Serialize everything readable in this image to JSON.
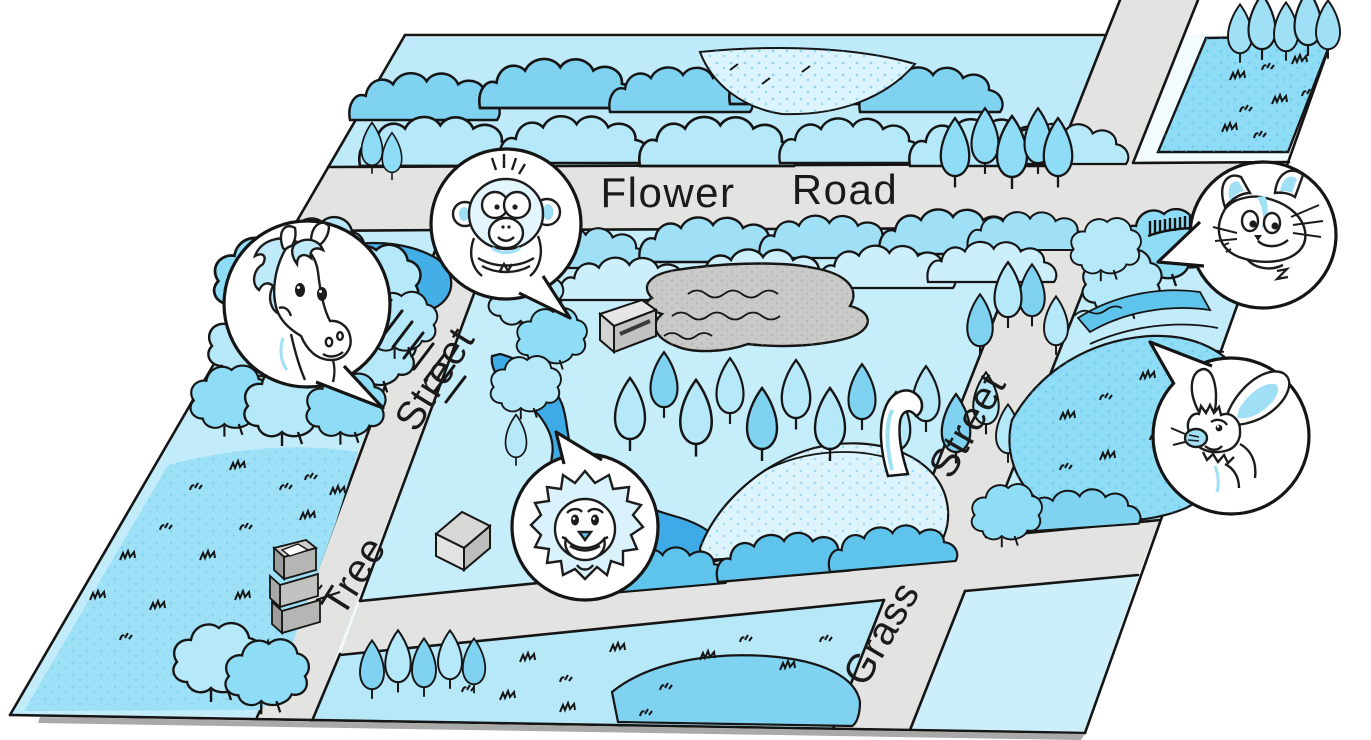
{
  "map": {
    "streets": {
      "flower_road": {
        "words": [
          "Flower",
          "Road"
        ]
      },
      "tree_street": {
        "words": [
          "Tree",
          "Street"
        ]
      },
      "grass_street": {
        "words": [
          "Grass",
          "Street"
        ]
      }
    },
    "animals": [
      "horse",
      "monkey",
      "cat",
      "rabbit",
      "lion"
    ],
    "features": [
      "forest",
      "park",
      "gray-pond",
      "river",
      "hill",
      "slide",
      "kiosk",
      "hut",
      "tower",
      "fence",
      "grass-field",
      "pond",
      "stream-terraces",
      "meadow"
    ],
    "colors": {
      "road": "#e3e3e1",
      "outline": "#151515",
      "light_cyan": "#c3ecfa",
      "mid_cyan": "#8edcf5",
      "deep_blue": "#3fabe6",
      "pond_gray": "#c9c9c7"
    }
  }
}
